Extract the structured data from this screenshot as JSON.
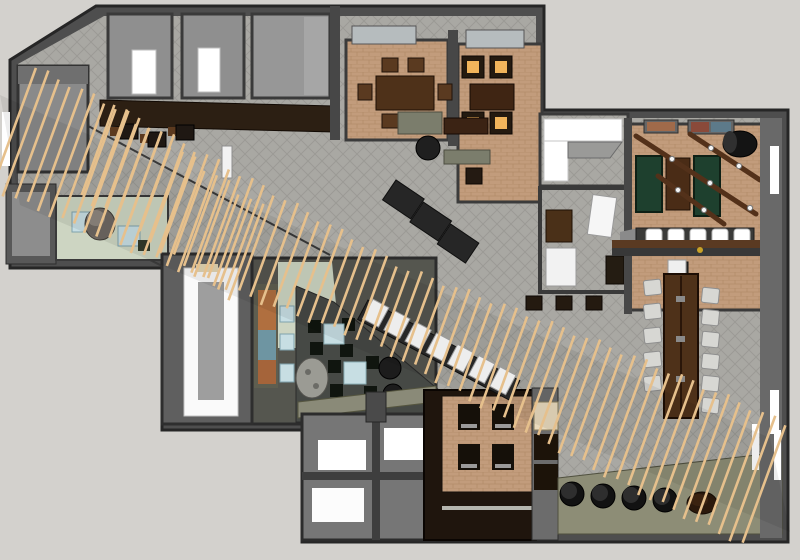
{
  "scene": {
    "description": "Top-down 3D architectural render of a restaurant interior floor plan (SketchUp style), crossed by a diagonal wood-slat canopy",
    "areas": [
      "entry-vestibule",
      "gallery-corridor",
      "upper-left-service-rooms",
      "bar-counter",
      "private-dining-room-1",
      "private-dining-room-2",
      "open-dining-atrium",
      "host-area",
      "banquette-nook",
      "meeting-room",
      "games-room",
      "communal-table-area",
      "lounge",
      "mural-wall",
      "brick-seating-nook",
      "restrooms",
      "slat-canopy"
    ]
  },
  "palette": {
    "background": "#d3d1cd",
    "wall": "#4e4e4e",
    "wallDark": "#2b2b2b",
    "wallMid": "#6e6e6e",
    "wallLight": "#919191",
    "floorCarpet": "#a9a8a3",
    "carpetLine": "#9b9a95",
    "floorBrick": "#c29c7c",
    "brickLine": "#ad8662",
    "floorCharcoal": "#464945",
    "floorPaleGreen": "#cdd5c2",
    "floorOlive": "#8d8d76",
    "woodDark": "#2c1f13",
    "woodMedium": "#4e3119",
    "beamBrown": "#53311a",
    "slat": "#e6c08c",
    "greenFelt": "#1e402e",
    "amberGlow": "#f1b45b",
    "seatBlue": "#c7dee3",
    "seatGray": "#d7d7d3",
    "seatCream": "#e9dabd",
    "black": "#141414",
    "white": "#ffffff",
    "skylight": "#b6bcbe",
    "muralOrange": "#b06f3f",
    "muralTeal": "#6e95a2"
  },
  "slats": {
    "main_count": 66,
    "secondary_count": 14,
    "angle_deg": 20
  },
  "furniture": {
    "dining1_chairs": 6,
    "dining2_glow_seats": 4,
    "games_tables": 3,
    "bar_stools_white": 5,
    "communal_chairs_left": 5,
    "communal_chairs_right": 6,
    "floor_stools_black": 4,
    "floor_stools_brown": 1,
    "nook_chairs": 4,
    "lounge_tables": 2,
    "banquette_seats": 7
  }
}
